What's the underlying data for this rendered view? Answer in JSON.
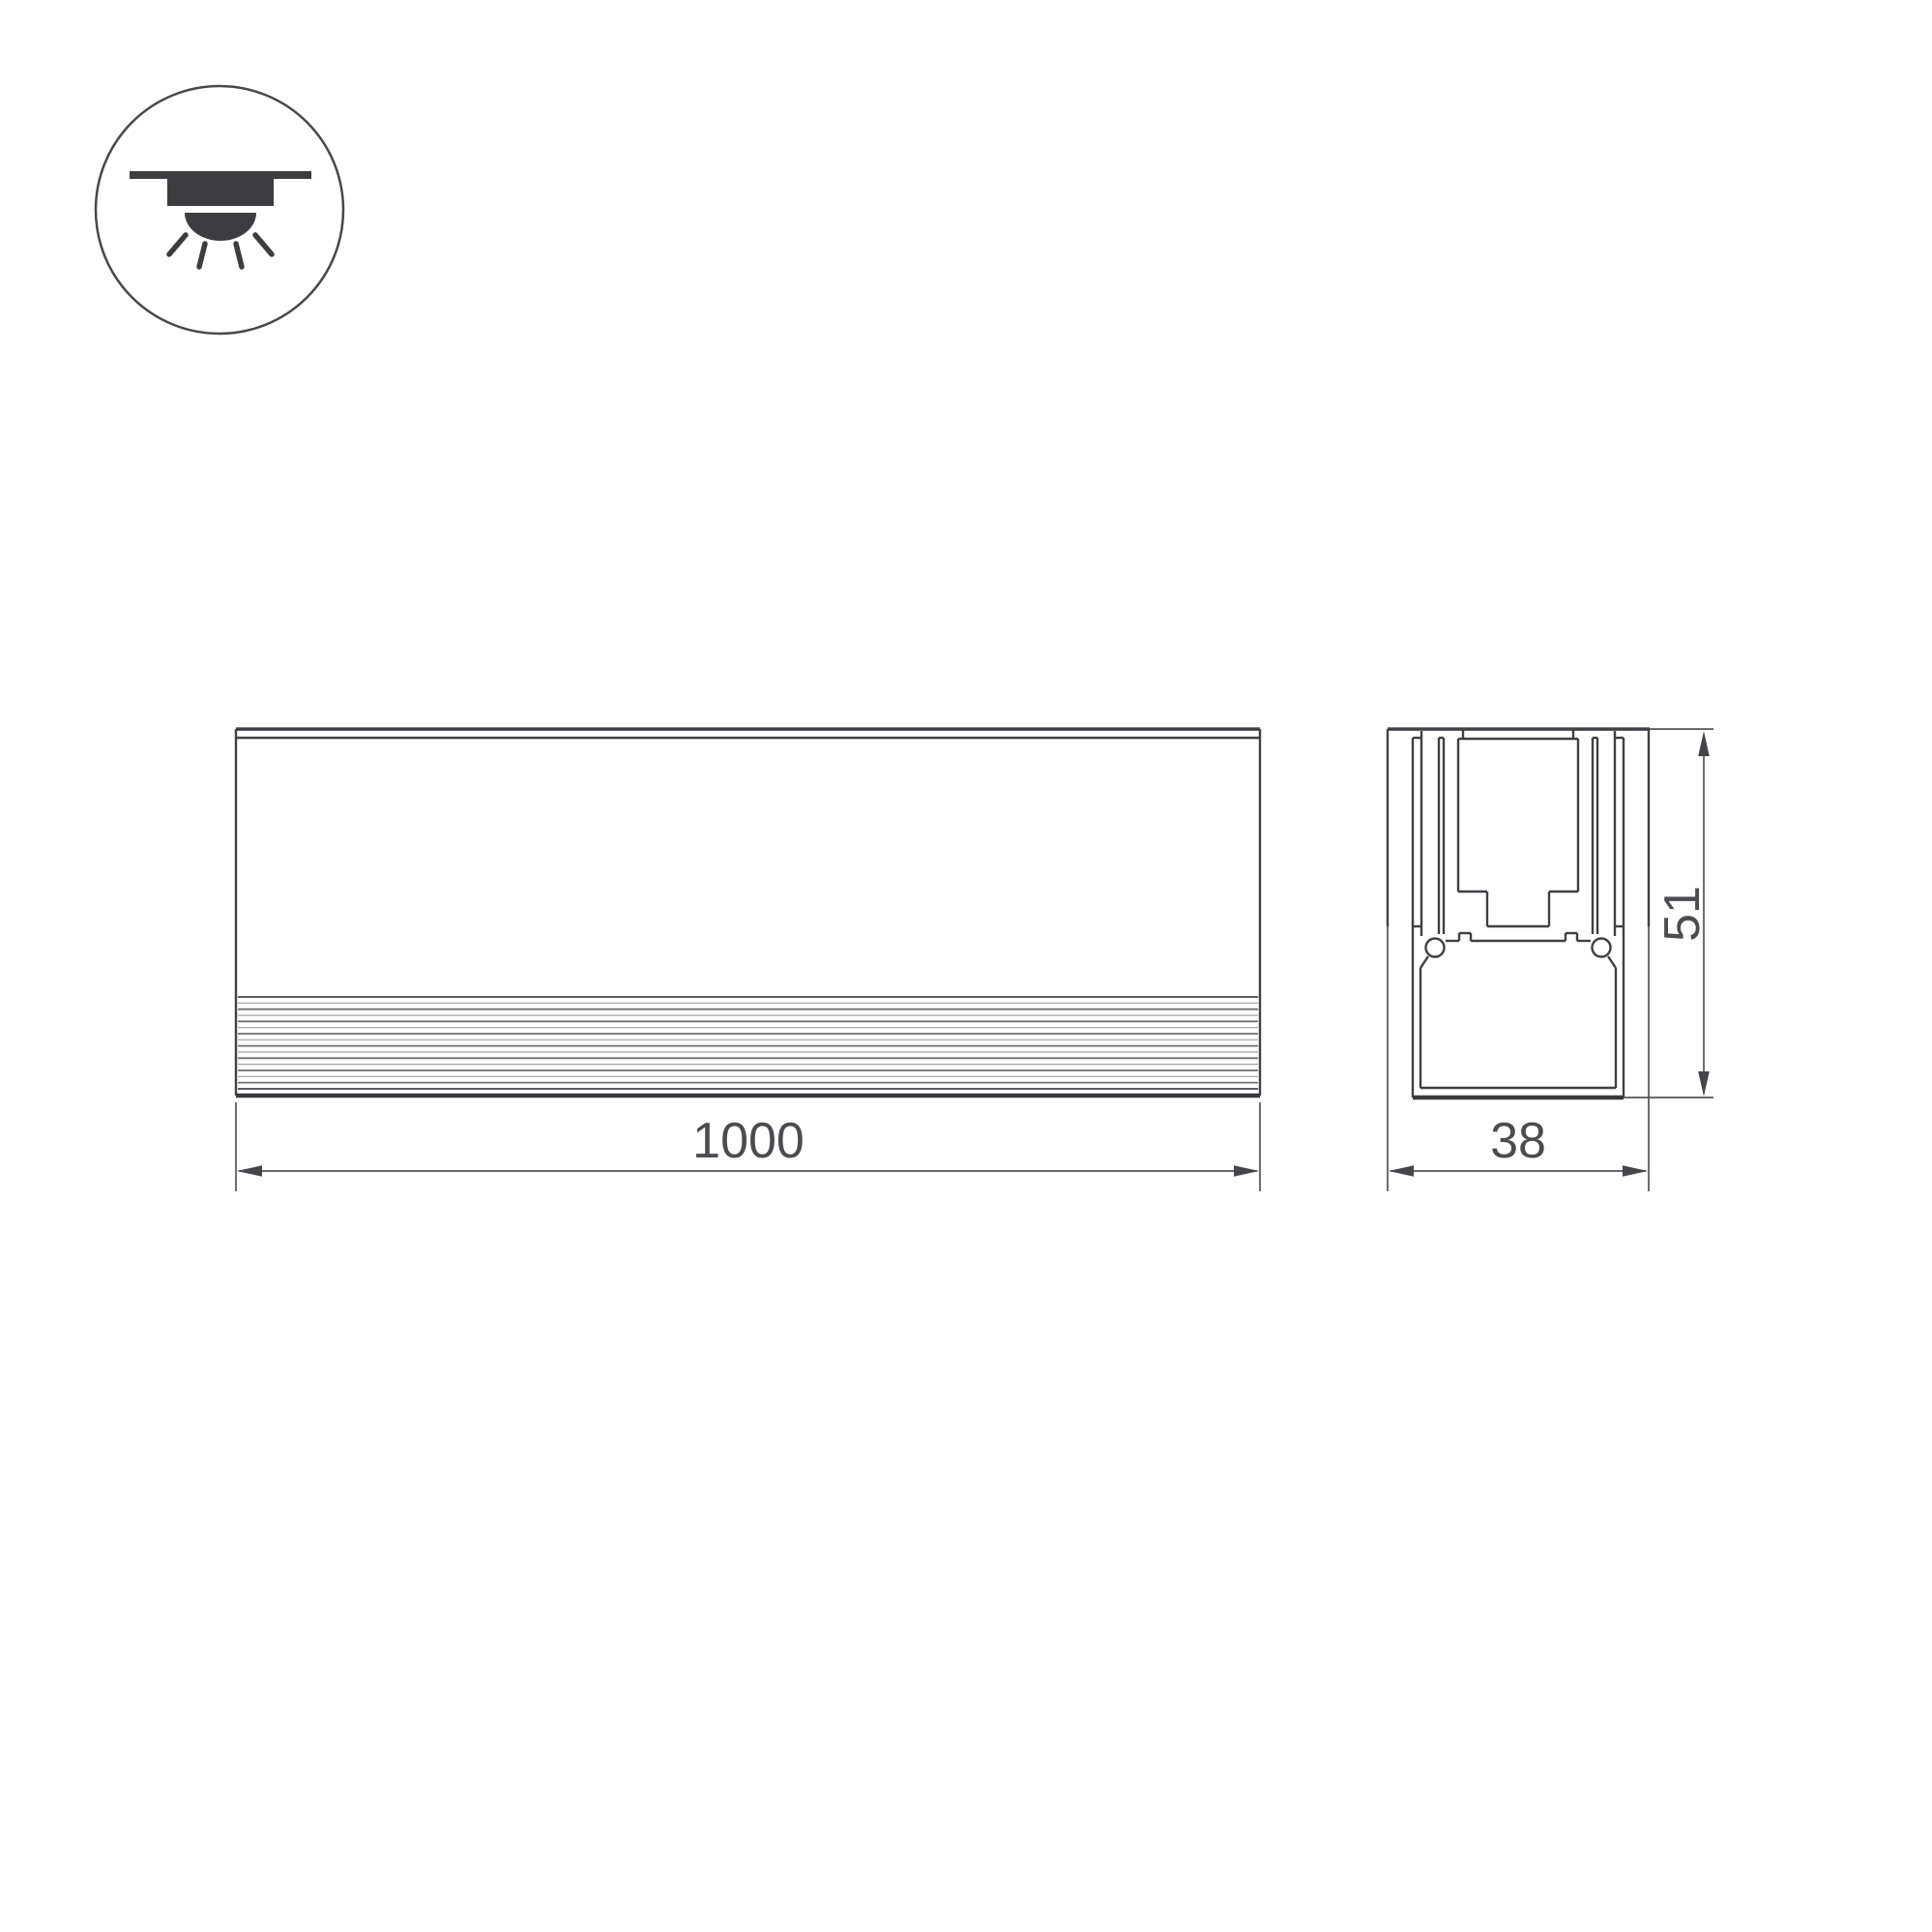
{
  "drawing": {
    "background": "#ffffff",
    "line_color": "#3f3f45",
    "dimension_line_color": "#55555a",
    "text_color": "#4b4b50",
    "description": "technical drawing of linear recessed LED profile, front view and cross-section"
  },
  "icon": {
    "name": "recessed-downlight-icon",
    "meaning": "recessed ceiling mounting with downward light"
  },
  "dimensions": {
    "length": {
      "value": "1000"
    },
    "width": {
      "value": "38"
    },
    "height": {
      "value": "51"
    }
  }
}
